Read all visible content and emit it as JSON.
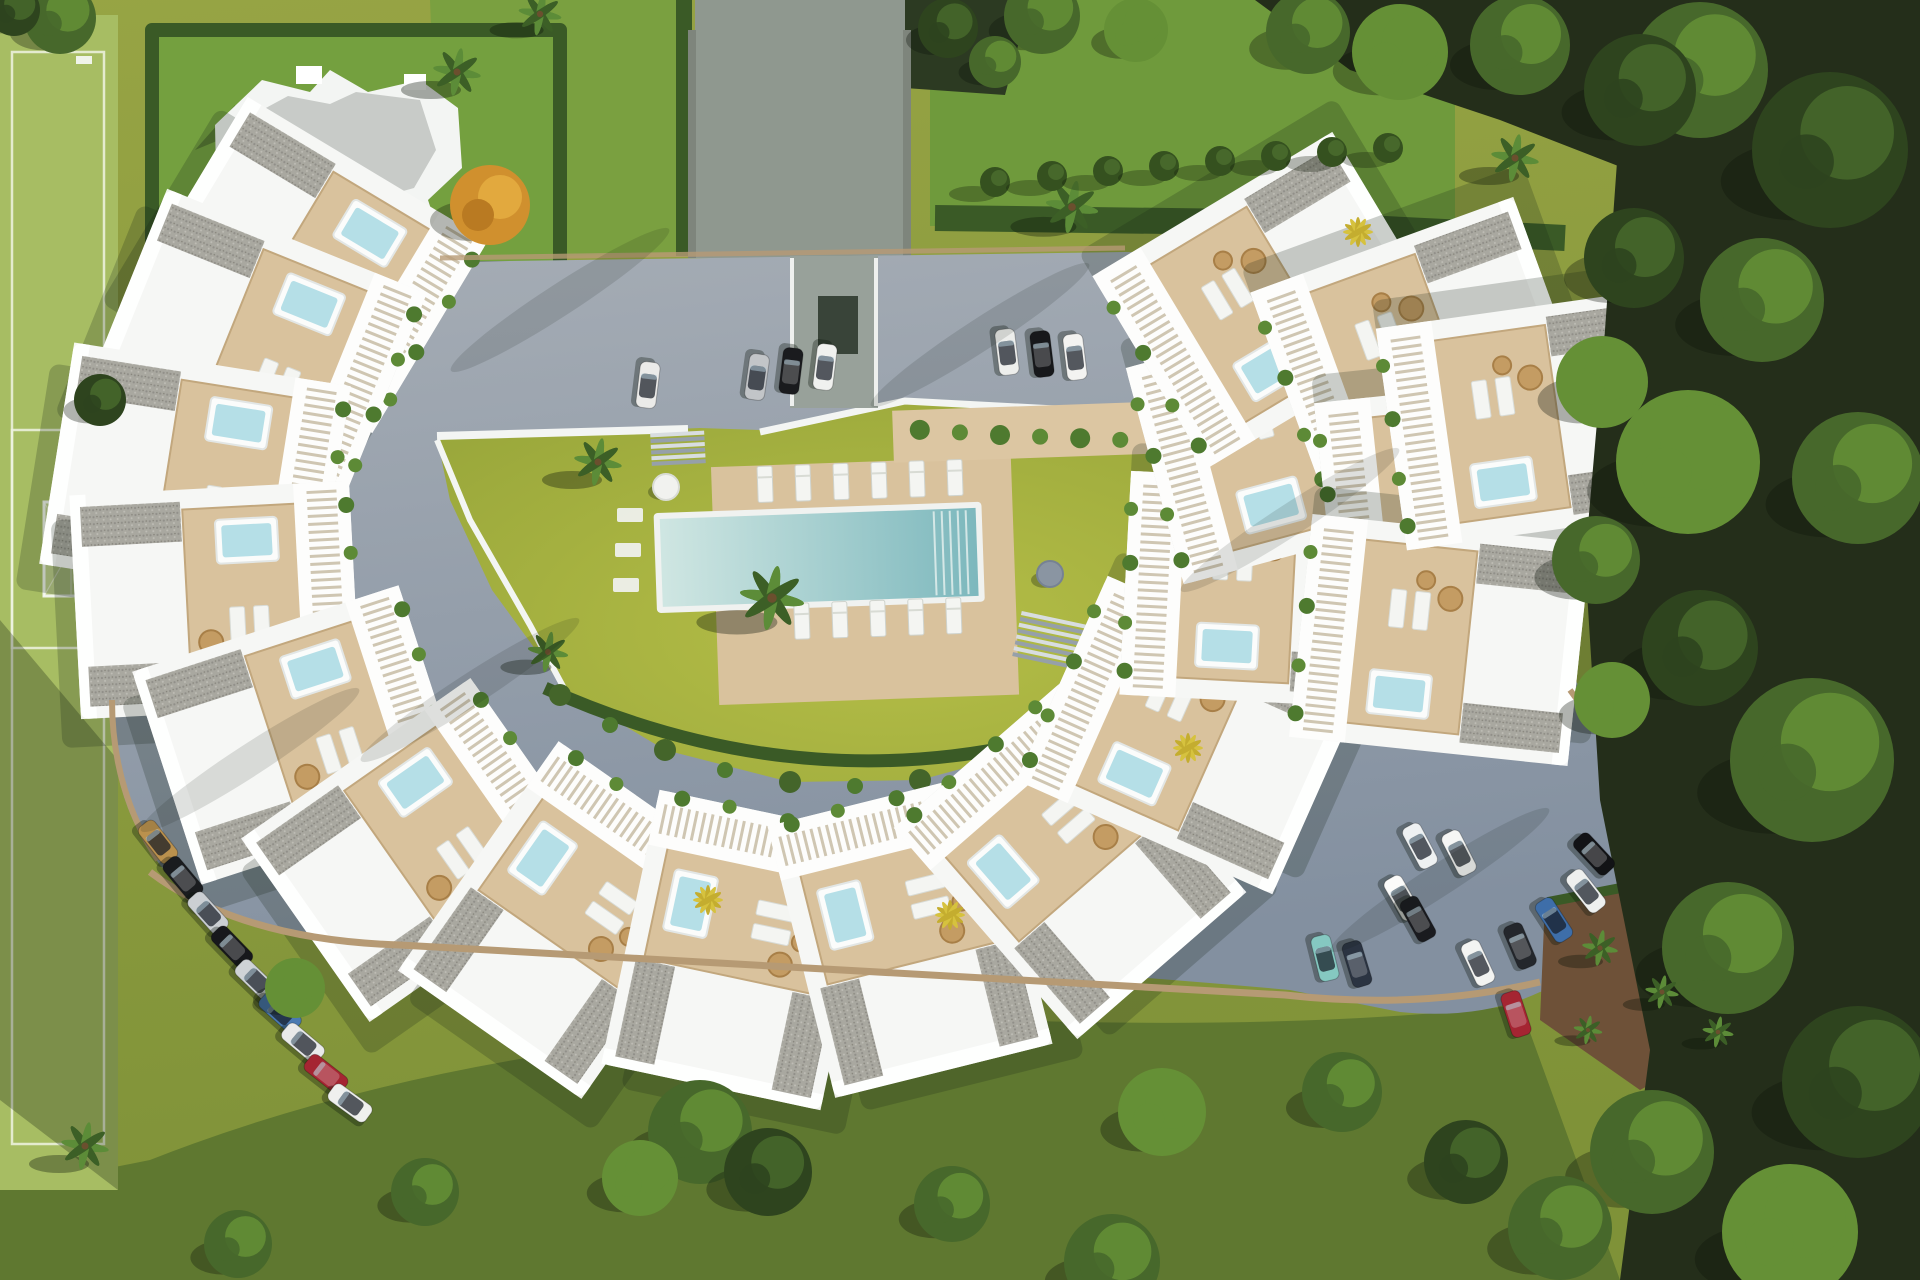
{
  "scene": {
    "name": "aerial-3d-render-residential-complex",
    "description": "Top-down architectural render: crescent of white apartment units with roof decks and jacuzzis around a central lawn and pool, ring road with parked cars, sports pitch left, detached villa top-left, forest right",
    "palette": {
      "base_a": "#97a444",
      "base_b": "#7f9238",
      "pitch": "#a7bd63",
      "pitch_line": "#eef3e2",
      "forest_floor": "#242e1a",
      "lawn_top": "#6f9a3c",
      "hedge": "#3a5a26",
      "hedge_light": "#4e7a2f",
      "road_a": "#a6adb5",
      "road_b": "#8390a0",
      "driveway": "#8f988f",
      "concrete": "#b6b9b1",
      "wall": "#7e857c",
      "court_a": "#b5be47",
      "court_b": "#99a73b",
      "deck": "#d9c29d",
      "deck_edge": "#c2a77d",
      "pool_a": "#cfe6e2",
      "pool_b": "#7db8bd",
      "jacuzzi": "#b5dfe7",
      "curb": "#b69a74",
      "soil": "#6e5138",
      "rattan": "#c49c63",
      "canopies": [
        "#2e441e",
        "#47682b",
        "#659036"
      ],
      "palm": "#5c8c38",
      "palm_dark": "#3c5f26",
      "palm_yellow": "#d6c23e",
      "orange_tree": "#d0902e",
      "building_white": "#f6f7f5",
      "gravel": "#a9a8a0"
    },
    "units": [
      [
        310,
        265,
        31
      ],
      [
        255,
        345,
        22
      ],
      [
        195,
        475,
        9
      ],
      [
        215,
        600,
        -3
      ],
      [
        300,
        735,
        -18
      ],
      [
        420,
        850,
        -35
      ],
      [
        570,
        920,
        -55
      ],
      [
        740,
        950,
        -78
      ],
      [
        910,
        935,
        -104
      ],
      [
        1070,
        860,
        -131
      ],
      [
        1190,
        735,
        -156
      ],
      [
        1265,
        590,
        -177
      ],
      [
        1290,
        440,
        165
      ],
      [
        1270,
        300,
        149
      ],
      [
        1420,
        350,
        160
      ],
      [
        1465,
        500,
        174
      ],
      [
        1440,
        640,
        -174
      ],
      [
        1530,
        420,
        172
      ]
    ],
    "cars": [
      [
        648,
        385,
        97,
        "#ebebe9"
      ],
      [
        757,
        377,
        98,
        "#c2c5c8"
      ],
      [
        791,
        371,
        97,
        "#1a1b1e"
      ],
      [
        825,
        367,
        97,
        "#f0f1ef"
      ],
      [
        1007,
        352,
        83,
        "#edeeec"
      ],
      [
        1042,
        354,
        83,
        "#17181b"
      ],
      [
        1075,
        357,
        83,
        "#f3f3f1"
      ],
      [
        158,
        842,
        52,
        "#bb914d"
      ],
      [
        183,
        878,
        50,
        "#1a1c1f"
      ],
      [
        208,
        913,
        48,
        "#cbcfd3"
      ],
      [
        232,
        947,
        46,
        "#17181c"
      ],
      [
        256,
        980,
        44,
        "#cfd3d6"
      ],
      [
        280,
        1012,
        42,
        "#4a7ab2"
      ],
      [
        303,
        1043,
        40,
        "#e9eaea"
      ],
      [
        326,
        1074,
        38,
        "#a52532"
      ],
      [
        350,
        1103,
        36,
        "#eff0ee"
      ],
      [
        1420,
        846,
        62,
        "#eef1f2"
      ],
      [
        1459,
        853,
        63,
        "#f5f6f5"
      ],
      [
        1402,
        898,
        60,
        "#fbfbfa"
      ],
      [
        1418,
        919,
        61,
        "#1a1b1f"
      ],
      [
        1325,
        958,
        76,
        "#85c8c1"
      ],
      [
        1357,
        964,
        73,
        "#2b3442"
      ],
      [
        1478,
        963,
        65,
        "#f3f4f2"
      ],
      [
        1520,
        946,
        67,
        "#24272c"
      ],
      [
        1554,
        920,
        57,
        "#3e6ea9"
      ],
      [
        1586,
        891,
        52,
        "#eef0ef"
      ],
      [
        1594,
        854,
        47,
        "#121316"
      ],
      [
        1516,
        1014,
        72,
        "#a52532"
      ]
    ],
    "forest_canopies": [
      [
        1700,
        70,
        68,
        1
      ],
      [
        1830,
        150,
        78,
        0
      ],
      [
        1762,
        300,
        62,
        1
      ],
      [
        1688,
        462,
        72,
        2
      ],
      [
        1858,
        478,
        66,
        1
      ],
      [
        1700,
        648,
        58,
        0
      ],
      [
        1812,
        760,
        82,
        1
      ],
      [
        1728,
        948,
        66,
        1
      ],
      [
        1858,
        1082,
        76,
        0
      ],
      [
        1652,
        1152,
        62,
        1
      ],
      [
        1790,
        1232,
        68,
        2
      ],
      [
        1634,
        258,
        50,
        0
      ],
      [
        1596,
        560,
        44,
        1
      ],
      [
        1640,
        90,
        56,
        0
      ],
      [
        1520,
        45,
        50,
        1
      ],
      [
        1400,
        52,
        48,
        2
      ],
      [
        1308,
        32,
        42,
        1
      ],
      [
        1602,
        382,
        46,
        2
      ]
    ],
    "lawn_trees": [
      [
        700,
        1132,
        52,
        1
      ],
      [
        768,
        1172,
        44,
        0
      ],
      [
        640,
        1178,
        38,
        2
      ],
      [
        425,
        1192,
        34,
        1
      ],
      [
        952,
        1204,
        38,
        1
      ],
      [
        1162,
        1112,
        44,
        2
      ],
      [
        1112,
        1262,
        48,
        1
      ],
      [
        1342,
        1092,
        40,
        1
      ],
      [
        238,
        1244,
        34,
        1
      ],
      [
        1466,
        1162,
        42,
        0
      ],
      [
        1560,
        1228,
        52,
        1
      ],
      [
        60,
        18,
        36,
        1
      ],
      [
        14,
        10,
        26,
        0
      ],
      [
        1042,
        16,
        38,
        1
      ],
      [
        1136,
        30,
        32,
        2
      ],
      [
        295,
        988,
        30,
        2
      ],
      [
        1612,
        700,
        38,
        2
      ],
      [
        100,
        400,
        26,
        0
      ],
      [
        948,
        28,
        30,
        0
      ],
      [
        995,
        62,
        26,
        1
      ]
    ],
    "palms": [
      [
        457,
        72,
        1.0
      ],
      [
        1072,
        207,
        1.1
      ],
      [
        598,
        462,
        1.0
      ],
      [
        772,
        598,
        1.35
      ],
      [
        548,
        652,
        0.85
      ],
      [
        85,
        1146,
        1.0
      ],
      [
        1515,
        158,
        1.0
      ],
      [
        540,
        14,
        0.9
      ],
      [
        1600,
        948,
        0.75
      ],
      [
        1662,
        992,
        0.7
      ],
      [
        1718,
        1032,
        0.65
      ],
      [
        1588,
        1030,
        0.6
      ]
    ],
    "yellow_palms": [
      [
        708,
        900
      ],
      [
        950,
        915
      ],
      [
        1188,
        748
      ],
      [
        1358,
        232
      ]
    ],
    "arc_shrubs": [
      [
        560,
        695
      ],
      [
        610,
        725
      ],
      [
        665,
        750
      ],
      [
        725,
        770
      ],
      [
        790,
        782
      ],
      [
        855,
        786
      ],
      [
        920,
        780
      ],
      [
        985,
        766
      ],
      [
        1045,
        746
      ],
      [
        1100,
        722
      ],
      [
        1150,
        692
      ],
      [
        1195,
        656
      ],
      [
        1232,
        615
      ]
    ],
    "hedge_bushes": [
      [
        995,
        182
      ],
      [
        1052,
        176
      ],
      [
        1108,
        171
      ],
      [
        1164,
        166
      ],
      [
        1220,
        161
      ],
      [
        1276,
        156
      ],
      [
        1332,
        152
      ],
      [
        1388,
        148
      ]
    ],
    "planter_shrubs": [
      [
        925,
        432
      ],
      [
        965,
        436
      ],
      [
        1005,
        440
      ],
      [
        1045,
        443
      ],
      [
        1085,
        446
      ],
      [
        1125,
        449
      ]
    ],
    "pool": {
      "x": 662,
      "y": 512,
      "w": 316,
      "h": 88,
      "rot": -2,
      "step_lines": 5
    },
    "loungers_top": {
      "y": 480,
      "xs": [
        768,
        806,
        844,
        882,
        920,
        958
      ]
    },
    "loungers_bottom": {
      "y": 618,
      "xs": [
        800,
        838,
        876,
        914,
        952
      ]
    },
    "pads": [
      [
        630,
        515
      ],
      [
        628,
        550
      ],
      [
        626,
        585
      ]
    ],
    "round_table": [
      1050,
      574,
      13
    ],
    "round_daybed": [
      666,
      487,
      13
    ],
    "orange_tree": [
      490,
      205,
      40
    ],
    "shadow_streaks": [
      [
        560,
        300
      ],
      [
        980,
        335
      ],
      [
        1290,
        520
      ],
      [
        470,
        690
      ],
      [
        1440,
        880
      ],
      [
        250,
        760
      ]
    ]
  }
}
